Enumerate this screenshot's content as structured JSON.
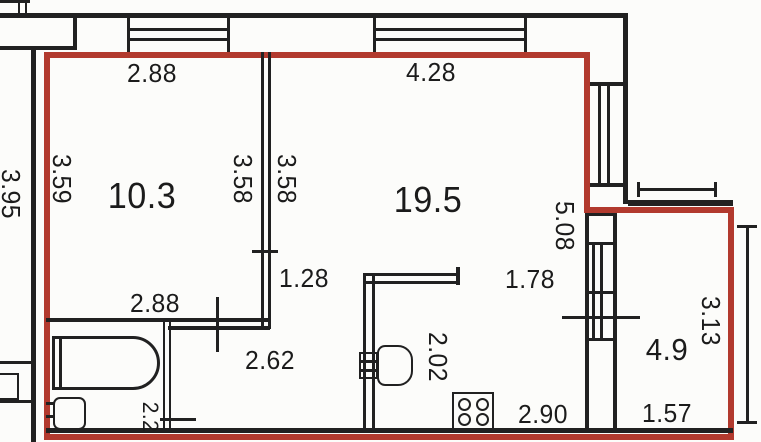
{
  "colors": {
    "boundary_red": "#b23a2e",
    "wall_black": "#212121",
    "background": "#fcfcfa"
  },
  "labels": {
    "dim_top_left": "2.88",
    "dim_top_right": "4.28",
    "area_room1": "10.3",
    "area_room2": "19.5",
    "area_balcony": "4.9",
    "area_bath": "2.2",
    "dim_left_outer": "3.95",
    "dim_left_inner": "3.59",
    "dim_mid_left": "3.58",
    "dim_mid_right": "3.58",
    "dim_wall_stub": "1.28",
    "dim_bottom_room": "2.88",
    "dim_corridor": "2.62",
    "dim_kitchen_opening": "1.78",
    "dim_right_height": "5.08",
    "dim_counter": "2.02",
    "dim_kitchen_width": "2.90",
    "dim_balcony_height": "3.13",
    "dim_balcony_width": "1.57"
  }
}
